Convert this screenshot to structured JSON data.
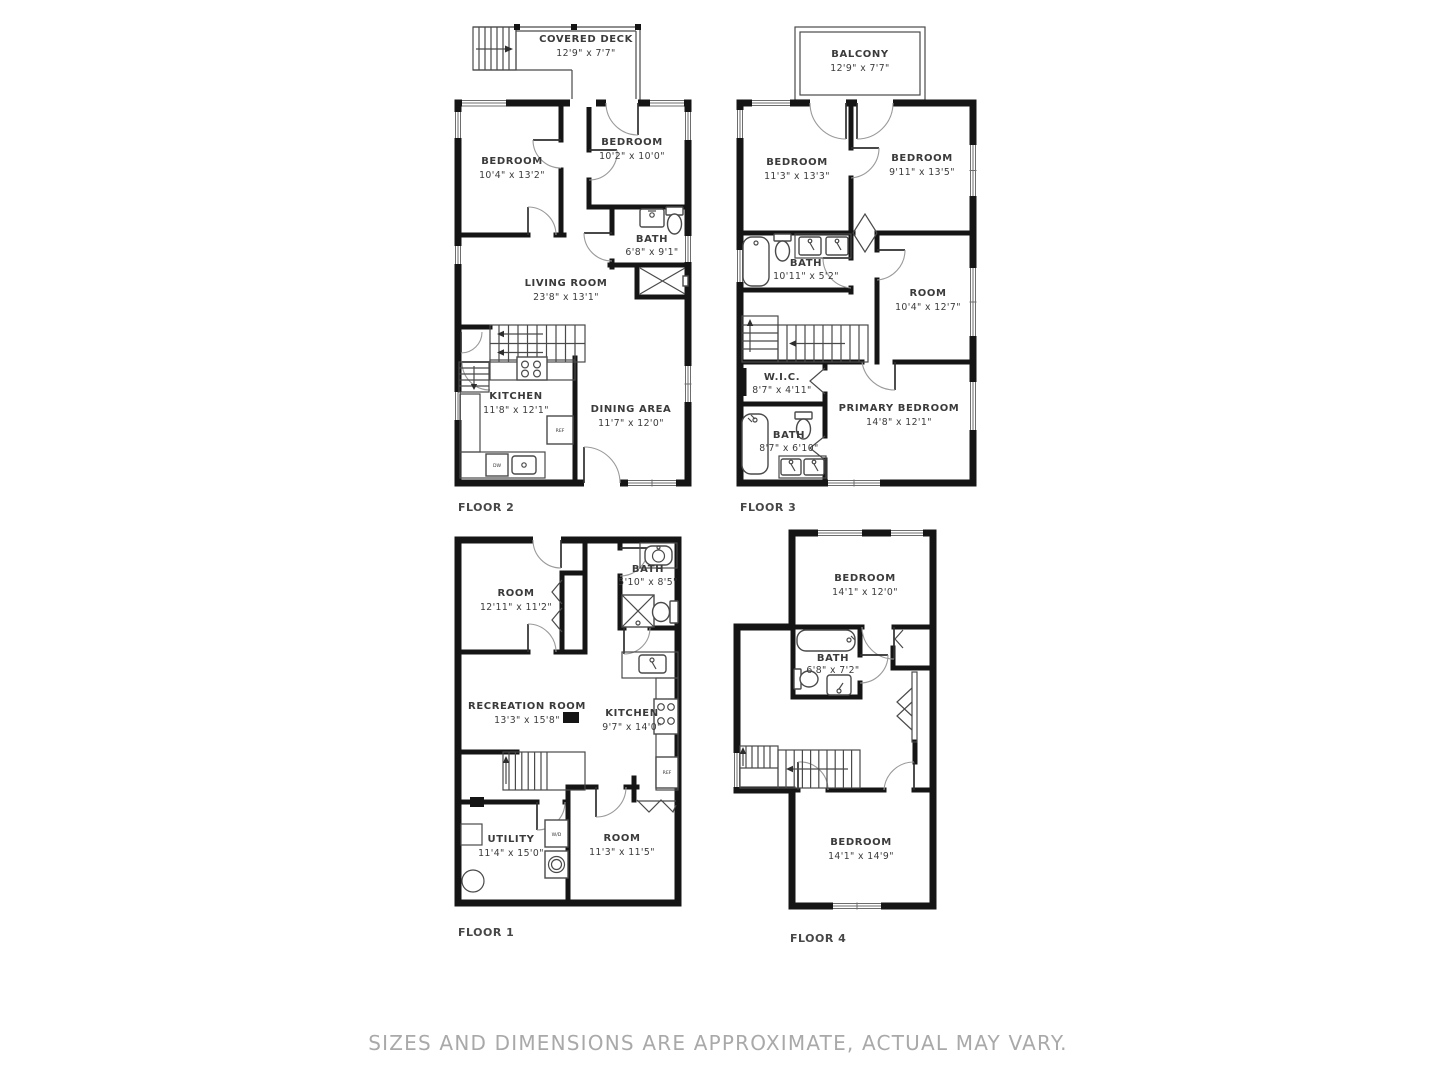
{
  "footer": {
    "disclaimer": "SIZES AND DIMENSIONS ARE APPROXIMATE, ACTUAL MAY VARY."
  },
  "labels": {
    "ref": "REF",
    "dw": "DW",
    "wd": "W/D"
  },
  "floor2": {
    "label": "FLOOR 2",
    "deck": {
      "name": "COVERED DECK",
      "dims": "12'9\" x 7'7\""
    },
    "bedroom1": {
      "name": "BEDROOM",
      "dims": "10'4\" x 13'2\""
    },
    "bedroom2": {
      "name": "BEDROOM",
      "dims": "10'2\" x 10'0\""
    },
    "bath": {
      "name": "BATH",
      "dims": "6'8\" x 9'1\""
    },
    "living": {
      "name": "LIVING ROOM",
      "dims": "23'8\" x 13'1\""
    },
    "kitchen": {
      "name": "KITCHEN",
      "dims": "11'8\" x 12'1\""
    },
    "dining": {
      "name": "DINING AREA",
      "dims": "11'7\" x 12'0\""
    }
  },
  "floor3": {
    "label": "FLOOR 3",
    "balcony": {
      "name": "BALCONY",
      "dims": "12'9\" x 7'7\""
    },
    "bedroom1": {
      "name": "BEDROOM",
      "dims": "11'3\" x 13'3\""
    },
    "bedroom2": {
      "name": "BEDROOM",
      "dims": "9'11\" x 13'5\""
    },
    "bath1": {
      "name": "BATH",
      "dims": "10'11\" x 5'2\""
    },
    "room": {
      "name": "ROOM",
      "dims": "10'4\" x 12'7\""
    },
    "wic": {
      "name": "W.I.C.",
      "dims": "8'7\" x 4'11\""
    },
    "bath2": {
      "name": "BATH",
      "dims": "8'7\" x 6'10\""
    },
    "primary": {
      "name": "PRIMARY BEDROOM",
      "dims": "14'8\" x 12'1\""
    }
  },
  "floor1": {
    "label": "FLOOR 1",
    "room1": {
      "name": "ROOM",
      "dims": "12'11\" x 11'2\""
    },
    "bath": {
      "name": "BATH",
      "dims": "5'10\" x 8'5\""
    },
    "recreation": {
      "name": "RECREATION ROOM",
      "dims": "13'3\" x 15'8\""
    },
    "kitchen": {
      "name": "KITCHEN",
      "dims": "9'7\" x 14'0\""
    },
    "utility": {
      "name": "UTILITY",
      "dims": "11'4\" x 15'0\""
    },
    "room2": {
      "name": "ROOM",
      "dims": "11'3\" x 11'5\""
    }
  },
  "floor4": {
    "label": "FLOOR 4",
    "bedroom1": {
      "name": "BEDROOM",
      "dims": "14'1\" x 12'0\""
    },
    "bath": {
      "name": "BATH",
      "dims": "6'8\" x 7'2\""
    },
    "bedroom2": {
      "name": "BEDROOM",
      "dims": "14'1\" x 14'9\""
    }
  }
}
